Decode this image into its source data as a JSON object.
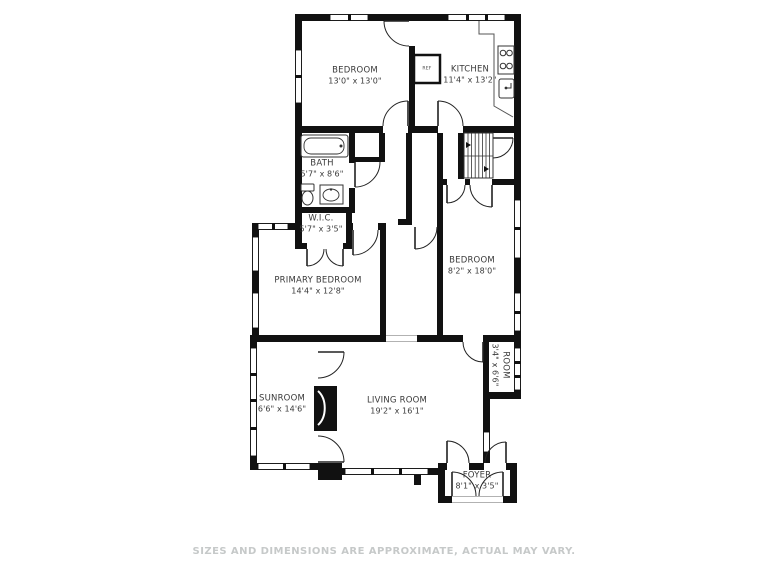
{
  "plan": {
    "disclaimer": "SIZES AND DIMENSIONS ARE APPROXIMATE, ACTUAL MAY VARY.",
    "colors": {
      "wall": "#111111",
      "label_text": "#3a3a3a",
      "disclaimer_text": "#c6c9c9",
      "background": "#ffffff"
    },
    "rooms": [
      {
        "name": "BEDROOM",
        "dims": "13'0\" x 13'0\""
      },
      {
        "name": "KITCHEN",
        "dims": "11'4\" x 13'2\""
      },
      {
        "name": "BATH",
        "dims": "5'7\" x 8'6\""
      },
      {
        "name": "W.I.C.",
        "dims": "5'7\" x 3'5\""
      },
      {
        "name": "PRIMARY BEDROOM",
        "dims": "14'4\" x 12'8\""
      },
      {
        "name": "BEDROOM",
        "dims": "8'2\" x 18'0\""
      },
      {
        "name": "SUNROOM",
        "dims": "6'6\" x 14'6\""
      },
      {
        "name": "LIVING ROOM",
        "dims": "19'2\" x 16'1\""
      },
      {
        "name": "ROOM",
        "dims": "3'4\" x 6'6\""
      },
      {
        "name": "FOYER",
        "dims": "8'1\" x 3'5\""
      }
    ],
    "fixtures": {
      "refrigerator_label": "REF"
    }
  }
}
